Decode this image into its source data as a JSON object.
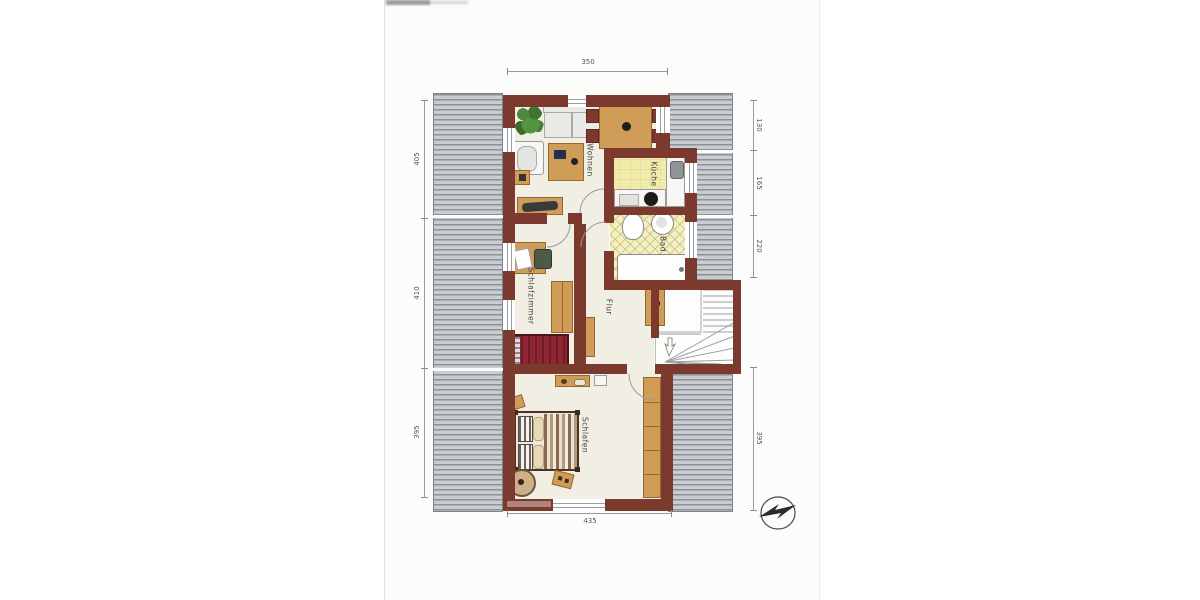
{
  "document": {
    "type": "scanned-floor-plan",
    "rooms": {
      "wohnen": "Wohnen",
      "kueche": "Küche",
      "bad": "Bad",
      "flur": "Flur",
      "schlafzimmer": "Schlafzimmer",
      "schlafen": "Schlafen"
    },
    "dimensions": {
      "top": "350",
      "bottom": "435",
      "left": [
        "405",
        "410",
        "395"
      ],
      "right": [
        "130",
        "165",
        "220",
        "395"
      ]
    }
  },
  "colors": {
    "wall": "#7c3a2e",
    "floor": "#f1eee3",
    "roof-light": "#c9cdd1",
    "roof-dark": "#8b9197",
    "kitchen-floor": "#f2ecab",
    "bath-floor": "#f4f0c4",
    "wood": "#cf9d58",
    "wood-dark": "#96682e",
    "bed-red": "#8e2733"
  }
}
